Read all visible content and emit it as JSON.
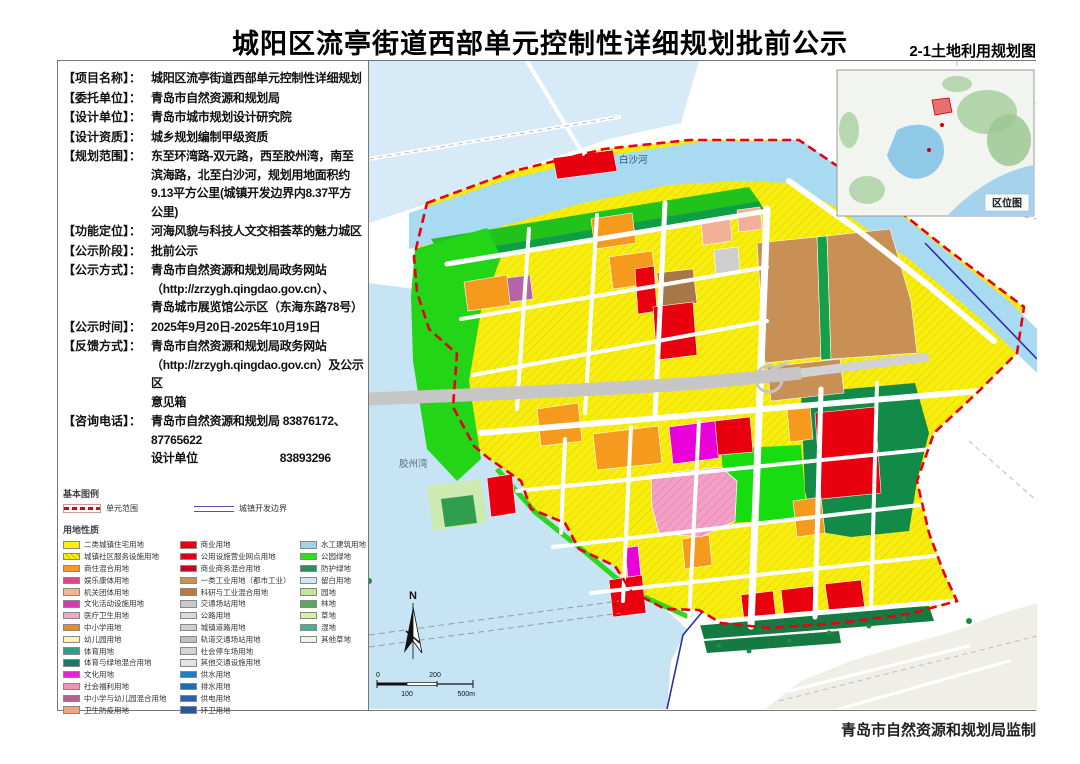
{
  "header": {
    "title": "城阳区流亭街道西部单元控制性详细规划批前公示",
    "map_code": "2-1土地利用规划图"
  },
  "info": [
    {
      "label": "【项目名称】：",
      "value": "城阳区流亭街道西部单元控制性详细规划"
    },
    {
      "label": "【委托单位】：",
      "value": "青岛市自然资源和规划局"
    },
    {
      "label": "【设计单位】：",
      "value": "青岛市城市规划设计研究院"
    },
    {
      "label": "【设计资质】：",
      "value": "城乡规划编制甲级资质"
    },
    {
      "label": "【规划范围】：",
      "value": "东至环湾路-双元路，西至胶州湾，南至\n滨海路，北至白沙河，规划用地面积约\n9.13平方公里(城镇开发边界内8.37平方\n公里)"
    },
    {
      "label": "【功能定位】：",
      "value": "河海风貌与科技人文交相荟萃的魅力城区"
    },
    {
      "label": "【公示阶段】：",
      "value": "批前公示"
    },
    {
      "label": "【公示方式】：",
      "value": "青岛市自然资源和规划局政务网站\n（http://zrzygh.qingdao.gov.cn）、\n青岛城市展览馆公示区（东海东路78号）"
    },
    {
      "label": "【公示时间】：",
      "value": "2025年9月20日-2025年10月19日"
    },
    {
      "label": "【反馈方式】：",
      "value": "青岛市自然资源和规划局政务网站\n（http://zrzygh.qingdao.gov.cn）及公示区\n意见箱"
    },
    {
      "label": "【咨询电话】：",
      "value": "青岛市自然资源和规划局 83876172、87765622\n设计单位　　　　　　　83893296"
    }
  ],
  "legend": {
    "title": "基本图例",
    "boundaries": [
      {
        "label": "单元范围",
        "type": "dash-red"
      },
      {
        "label": "城镇开发边界",
        "type": "line-blue"
      }
    ],
    "subtitle": "用地性质",
    "columns": [
      [
        {
          "color": "#fef102",
          "label": "二类城镇住宅用地"
        },
        {
          "color": "#fef102",
          "hatch": true,
          "label": "城镇社区服务设施用地"
        },
        {
          "color": "#f59a23",
          "label": "商住混合用地"
        },
        {
          "color": "#e7418d",
          "label": "娱乐康体用地"
        },
        {
          "color": "#f5b48e",
          "label": "机关团体用地"
        },
        {
          "color": "#d53ab4",
          "label": "文化活动设施用地"
        },
        {
          "color": "#f2a8c4",
          "label": "医疗卫生用地"
        },
        {
          "color": "#f08b1d",
          "label": "中小学用地"
        },
        {
          "color": "#fdf6a3",
          "label": "幼儿园用地"
        },
        {
          "color": "#2aa08a",
          "label": "体育用地"
        },
        {
          "color": "#157a68",
          "label": "体育与绿地混合用地"
        },
        {
          "color": "#ea1fd3",
          "label": "文化用地"
        },
        {
          "color": "#ef93b5",
          "label": "社会福利用地"
        },
        {
          "color": "#b85f92",
          "label": "中小学与幼儿园混合用地"
        },
        {
          "color": "#f2a384",
          "label": "卫生防疫用地"
        }
      ],
      [
        {
          "color": "#e60012",
          "label": "商业用地"
        },
        {
          "color": "#e60012",
          "hatch": true,
          "label": "公用设施营业网点用地"
        },
        {
          "color": "#c9001a",
          "label": "商业商务混合用地"
        },
        {
          "color": "#c89054",
          "label": "一类工业用地（都市工业）"
        },
        {
          "color": "#b87a42",
          "label": "科研与工业混合用地"
        },
        {
          "color": "#c9c9c9",
          "label": "交通场站用地"
        },
        {
          "color": "#d9d9d9",
          "label": "公路用地"
        },
        {
          "color": "#cfcfcf",
          "label": "城镇道路用地"
        },
        {
          "color": "#c0c0c0",
          "label": "轨道交通场站用地"
        },
        {
          "color": "#d4d4d4",
          "label": "社会停车场用地"
        },
        {
          "color": "#e2e2e2",
          "label": "其他交通设施用地"
        },
        {
          "color": "#1f7ec2",
          "label": "供水用地"
        },
        {
          "color": "#1f6eb4",
          "label": "排水用地"
        },
        {
          "color": "#2a62a8",
          "label": "供电用地"
        },
        {
          "color": "#27589c",
          "label": "环卫用地"
        }
      ],
      [
        {
          "color": "#9fd4ea",
          "label": "水工建筑用地"
        },
        {
          "color": "#2ee01c",
          "label": "公园绿地"
        },
        {
          "color": "#2e8f57",
          "label": "防护绿地"
        },
        {
          "color": "#cfe8f2",
          "label": "留白用地"
        },
        {
          "color": "#c2e596",
          "label": "园地"
        },
        {
          "color": "#57a661",
          "label": "林地"
        },
        {
          "color": "#d9f09e",
          "label": "草地"
        },
        {
          "color": "#43b394",
          "label": "湿地"
        },
        {
          "color": "#eef4ee",
          "label": "其他草地"
        }
      ]
    ]
  },
  "map": {
    "river_label": "白沙河",
    "bay_label": "胶州湾",
    "inset_label": "区位图",
    "north_label": "N",
    "scale": {
      "zero": "0",
      "two_hundred": "200",
      "one_hundred": "100",
      "five_hundred": "500m"
    }
  },
  "footer": {
    "credit": "青岛市自然资源和规划局监制"
  }
}
